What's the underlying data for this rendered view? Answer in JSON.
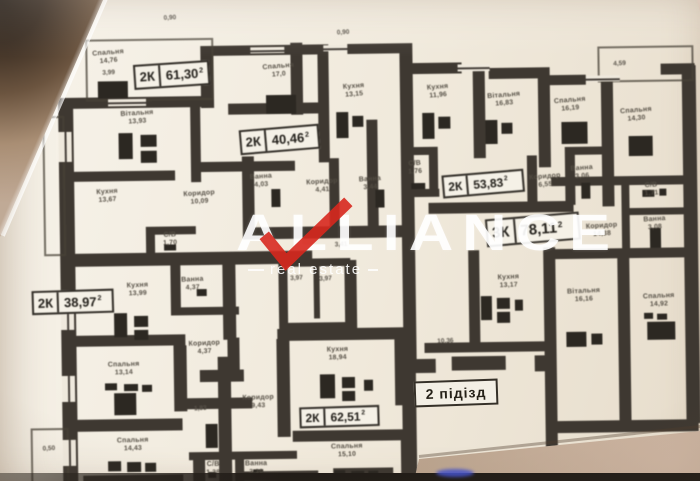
{
  "watermark": {
    "title": "ALLIANCE",
    "subtitle": "real estate"
  },
  "entrance": {
    "label": "2 підізд",
    "x": 414,
    "y": 380,
    "w": 84,
    "h": 26,
    "fs": 14,
    "rot": -2
  },
  "badges": [
    {
      "type": "2К",
      "area": "61,30",
      "sup": "2",
      "x": 136,
      "y": 60,
      "w": 76,
      "h": 25,
      "fs": 13,
      "rot": -3
    },
    {
      "type": "2К",
      "area": "40,46",
      "sup": "2",
      "x": 241,
      "y": 126,
      "w": 80,
      "h": 25,
      "fs": 13,
      "rot": -4
    },
    {
      "type": "2К",
      "area": "53,83",
      "sup": "2",
      "x": 443,
      "y": 174,
      "w": 82,
      "h": 23,
      "fs": 12,
      "rot": -4
    },
    {
      "type": "3К",
      "area": "78,11",
      "sup": "2",
      "x": 486,
      "y": 218,
      "w": 94,
      "h": 28,
      "fs": 15,
      "rot": -4
    },
    {
      "type": "2К",
      "area": "38,97",
      "sup": "2",
      "x": 31,
      "y": 286,
      "w": 82,
      "h": 24,
      "fs": 13,
      "rot": -1
    },
    {
      "type": "2К",
      "area": "62,51",
      "sup": "2",
      "x": 297,
      "y": 406,
      "w": 80,
      "h": 21,
      "fs": 12,
      "rot": -1
    }
  ],
  "rooms": [
    {
      "name": "Спальня",
      "area": "14,76",
      "x": 111,
      "y": 46,
      "rot": -4
    },
    {
      "name": "Вітальня",
      "area": "13,93",
      "x": 139,
      "y": 107,
      "rot": -3
    },
    {
      "name": "Кухня",
      "area": "13,67",
      "x": 108,
      "y": 185,
      "rot": -3
    },
    {
      "name": "Коридор",
      "area": "10,09",
      "x": 200,
      "y": 188,
      "rot": -3
    },
    {
      "name": "С/В",
      "area": "1,70",
      "x": 170,
      "y": 229,
      "rot": -2
    },
    {
      "name": "Спальня",
      "area": "17,0",
      "x": 281,
      "y": 62,
      "rot": -4
    },
    {
      "name": "Кухня",
      "area": "13,15",
      "x": 356,
      "y": 83,
      "rot": -4
    },
    {
      "name": "Ванна",
      "area": "4,03",
      "x": 262,
      "y": 172,
      "rot": -3
    },
    {
      "name": "Коридор",
      "area": "4,41",
      "x": 323,
      "y": 178,
      "rot": -3
    },
    {
      "name": "Ванна",
      "area": "3,44",
      "x": 371,
      "y": 176,
      "rot": -3
    },
    {
      "name": "Кухня",
      "area": "11,96",
      "x": 440,
      "y": 85,
      "rot": -4
    },
    {
      "name": "Вітальня",
      "area": "16,83",
      "x": 506,
      "y": 94,
      "rot": -4
    },
    {
      "name": "С/В",
      "area": "1,76",
      "x": 416,
      "y": 161,
      "rot": -3
    },
    {
      "name": "Коридор",
      "area": "6,55",
      "x": 546,
      "y": 176,
      "rot": -4
    },
    {
      "name": "Ванна",
      "area": "3,06",
      "x": 583,
      "y": 168,
      "rot": -4
    },
    {
      "name": "Спальня",
      "area": "16,19",
      "x": 572,
      "y": 100,
      "rot": -4
    },
    {
      "name": "Спальня",
      "area": "14,30",
      "x": 638,
      "y": 111,
      "rot": -4
    },
    {
      "name": "С/В",
      "area": "1,71",
      "x": 652,
      "y": 186,
      "rot": -3
    },
    {
      "name": "Ванна",
      "area": "3,08",
      "x": 655,
      "y": 220,
      "rot": -3
    },
    {
      "name": "Коридор",
      "area": "14,38",
      "x": 602,
      "y": 226,
      "rot": -3
    },
    {
      "name": "Кухня",
      "area": "13,17",
      "x": 508,
      "y": 276,
      "rot": -2
    },
    {
      "name": "Вітальня",
      "area": "16,16",
      "x": 583,
      "y": 291,
      "rot": -2
    },
    {
      "name": "Спальня",
      "area": "14,92",
      "x": 658,
      "y": 297,
      "rot": -2
    },
    {
      "name": "Кухня",
      "area": "13,99",
      "x": 137,
      "y": 279,
      "rot": -2
    },
    {
      "name": "Ванна",
      "area": "4,37",
      "x": 192,
      "y": 274,
      "rot": -2
    },
    {
      "name": "Коридор",
      "area": "4,37",
      "x": 203,
      "y": 338,
      "rot": -2
    },
    {
      "name": "Спальня",
      "area": "13,14",
      "x": 122,
      "y": 358,
      "rot": -1
    },
    {
      "name": "Спальня",
      "area": "14,43",
      "x": 130,
      "y": 434,
      "rot": -1
    },
    {
      "name": "Кухня",
      "area": "18,94",
      "x": 336,
      "y": 346,
      "rot": -1
    },
    {
      "name": "Коридор",
      "area": "9,43",
      "x": 256,
      "y": 393,
      "rot": -1
    },
    {
      "name": "Спальня",
      "area": "15,10",
      "x": 344,
      "y": 443,
      "rot": -1
    },
    {
      "name": "Ванна",
      "area": "3,36",
      "x": 253,
      "y": 459,
      "rot": 0
    },
    {
      "name": "С/В",
      "area": "1,38",
      "x": 210,
      "y": 459,
      "rot": 0
    }
  ],
  "dims": [
    {
      "text": "0,90",
      "x": 173,
      "y": 12
    },
    {
      "text": "0,90",
      "x": 346,
      "y": 29
    },
    {
      "text": "3,99",
      "x": 111,
      "y": 66
    },
    {
      "text": "4,59",
      "x": 622,
      "y": 64
    },
    {
      "text": "10,36",
      "x": 444,
      "y": 339
    },
    {
      "text": "3,97",
      "x": 296,
      "y": 274
    },
    {
      "text": "3,97",
      "x": 325,
      "y": 275
    },
    {
      "text": "3,41",
      "x": 341,
      "y": 241
    },
    {
      "text": "1,83",
      "x": 198,
      "y": 403
    },
    {
      "text": "0,50",
      "x": 46,
      "y": 441
    }
  ],
  "plan": {
    "walls": [
      [
        60,
        94,
        15,
        386
      ],
      [
        60,
        94,
        152,
        11
      ],
      [
        203,
        44,
        13,
        62
      ],
      [
        203,
        44,
        120,
        10
      ],
      [
        350,
        44,
        64,
        10
      ],
      [
        293,
        42,
        12,
        72
      ],
      [
        230,
        102,
        92,
        11
      ],
      [
        243,
        155,
        12,
        80
      ],
      [
        320,
        44,
        11,
        118
      ],
      [
        330,
        158,
        10,
        78
      ],
      [
        368,
        120,
        11,
        116
      ],
      [
        243,
        226,
        172,
        12
      ],
      [
        192,
        105,
        10,
        75
      ],
      [
        64,
        168,
        112,
        10
      ],
      [
        200,
        160,
        96,
        10
      ],
      [
        60,
        250,
        252,
        13
      ],
      [
        146,
        224,
        50,
        8
      ],
      [
        146,
        224,
        9,
        28
      ],
      [
        402,
        44,
        13,
        198
      ],
      [
        402,
        64,
        62,
        11
      ],
      [
        491,
        70,
        51,
        11
      ],
      [
        540,
        70,
        12,
        18
      ],
      [
        552,
        78,
        36,
        10
      ],
      [
        663,
        68,
        34,
        11
      ],
      [
        684,
        70,
        14,
        358
      ],
      [
        475,
        68,
        12,
        92
      ],
      [
        402,
        148,
        37,
        8
      ],
      [
        430,
        150,
        9,
        44
      ],
      [
        402,
        190,
        38,
        8
      ],
      [
        540,
        80,
        12,
        90
      ],
      [
        603,
        80,
        12,
        130
      ],
      [
        429,
        204,
        145,
        11
      ],
      [
        528,
        158,
        10,
        50
      ],
      [
        566,
        150,
        10,
        58
      ],
      [
        566,
        150,
        45,
        8
      ],
      [
        552,
        180,
        144,
        9
      ],
      [
        622,
        183,
        8,
        78
      ],
      [
        622,
        212,
        66,
        7
      ],
      [
        622,
        254,
        66,
        8
      ],
      [
        552,
        252,
        144,
        10
      ],
      [
        543,
        250,
        12,
        230
      ],
      [
        617,
        255,
        12,
        172
      ],
      [
        543,
        424,
        153,
        12
      ],
      [
        468,
        252,
        11,
        96
      ],
      [
        423,
        344,
        122,
        10
      ],
      [
        402,
        242,
        13,
        122
      ],
      [
        400,
        360,
        34,
        14
      ],
      [
        450,
        358,
        54,
        14
      ],
      [
        533,
        358,
        12,
        16
      ],
      [
        400,
        374,
        14,
        106
      ],
      [
        276,
        328,
        120,
        12
      ],
      [
        275,
        338,
        13,
        98
      ],
      [
        393,
        328,
        13,
        78
      ],
      [
        290,
        430,
        108,
        11
      ],
      [
        398,
        430,
        14,
        50
      ],
      [
        198,
        368,
        44,
        12
      ],
      [
        226,
        336,
        12,
        36
      ],
      [
        216,
        355,
        13,
        126
      ],
      [
        222,
        258,
        13,
        80
      ],
      [
        278,
        258,
        72,
        8
      ],
      [
        278,
        262,
        9,
        68
      ],
      [
        313,
        266,
        6,
        52
      ],
      [
        344,
        260,
        12,
        70
      ],
      [
        278,
        322,
        72,
        8
      ],
      [
        170,
        260,
        10,
        48
      ],
      [
        170,
        305,
        68,
        8
      ],
      [
        66,
        332,
        118,
        11
      ],
      [
        172,
        343,
        13,
        66
      ],
      [
        180,
        396,
        70,
        11
      ],
      [
        62,
        416,
        118,
        12
      ],
      [
        186,
        450,
        108,
        8
      ],
      [
        190,
        455,
        12,
        26
      ],
      [
        232,
        452,
        9,
        28
      ],
      [
        80,
        472,
        100,
        9
      ],
      [
        235,
        470,
        80,
        9
      ],
      [
        330,
        468,
        60,
        9
      ]
    ],
    "outlines": [
      [
        88,
        36,
        124,
        58
      ],
      [
        600,
        50,
        92,
        32
      ],
      [
        44,
        112,
        18,
        136
      ],
      [
        28,
        424,
        34,
        52
      ]
    ],
    "windows": [
      [
        110,
        96,
        38,
        7,
        "h"
      ],
      [
        253,
        46,
        34,
        6,
        "h"
      ],
      [
        326,
        45,
        24,
        6,
        "h"
      ],
      [
        460,
        66,
        32,
        7,
        "h"
      ],
      [
        588,
        79,
        34,
        6,
        "h"
      ],
      [
        60,
        128,
        13,
        30,
        "v"
      ],
      [
        60,
        298,
        13,
        28,
        "v"
      ],
      [
        60,
        372,
        13,
        26,
        "v"
      ],
      [
        60,
        436,
        13,
        26,
        "v"
      ]
    ],
    "icons": [
      [
        100,
        78,
        30,
        17
      ],
      [
        120,
        130,
        14,
        26
      ],
      [
        142,
        132,
        16,
        12
      ],
      [
        142,
        148,
        16,
        12
      ],
      [
        268,
        94,
        30,
        19
      ],
      [
        338,
        112,
        12,
        26
      ],
      [
        354,
        116,
        11,
        11
      ],
      [
        424,
        114,
        12,
        26
      ],
      [
        440,
        118,
        12,
        12
      ],
      [
        487,
        122,
        12,
        24
      ],
      [
        503,
        125,
        11,
        11
      ],
      [
        563,
        125,
        26,
        22
      ],
      [
        630,
        140,
        24,
        20
      ],
      [
        412,
        184,
        14,
        6
      ],
      [
        164,
        242,
        12,
        6
      ],
      [
        272,
        188,
        9,
        18
      ],
      [
        376,
        190,
        9,
        18
      ],
      [
        582,
        186,
        9,
        16
      ],
      [
        643,
        194,
        12,
        7
      ],
      [
        660,
        193,
        7,
        7
      ],
      [
        650,
        232,
        11,
        20
      ],
      [
        480,
        298,
        11,
        24
      ],
      [
        496,
        300,
        13,
        11
      ],
      [
        496,
        314,
        13,
        11
      ],
      [
        514,
        302,
        8,
        11
      ],
      [
        565,
        335,
        20,
        15
      ],
      [
        590,
        337,
        11,
        11
      ],
      [
        646,
        326,
        28,
        18
      ],
      [
        643,
        317,
        9,
        6
      ],
      [
        656,
        318,
        10,
        6
      ],
      [
        318,
        374,
        15,
        24
      ],
      [
        340,
        377,
        13,
        11
      ],
      [
        340,
        391,
        13,
        10
      ],
      [
        362,
        380,
        9,
        11
      ],
      [
        113,
        310,
        13,
        24
      ],
      [
        133,
        313,
        14,
        11
      ],
      [
        133,
        327,
        14,
        10
      ],
      [
        196,
        287,
        10,
        7
      ],
      [
        112,
        390,
        22,
        22
      ],
      [
        103,
        380,
        12,
        7
      ],
      [
        122,
        381,
        14,
        7
      ],
      [
        140,
        382,
        10,
        7
      ],
      [
        105,
        458,
        13,
        10
      ],
      [
        124,
        459,
        14,
        10
      ],
      [
        142,
        460,
        11,
        9
      ],
      [
        331,
        470,
        11,
        6
      ],
      [
        348,
        471,
        13,
        6
      ],
      [
        365,
        471,
        10,
        6
      ],
      [
        203,
        422,
        12,
        24
      ],
      [
        250,
        468,
        10,
        8
      ],
      [
        205,
        470,
        8,
        6
      ]
    ]
  },
  "colors": {
    "paper": "#f2ede2",
    "wall": "#3e3831",
    "badge_border": "#312d27",
    "watermark_text": "#ffffff",
    "check_red": "#d7281e",
    "table_surface": "#c2ab98",
    "pen_blue": "#4452c8"
  }
}
